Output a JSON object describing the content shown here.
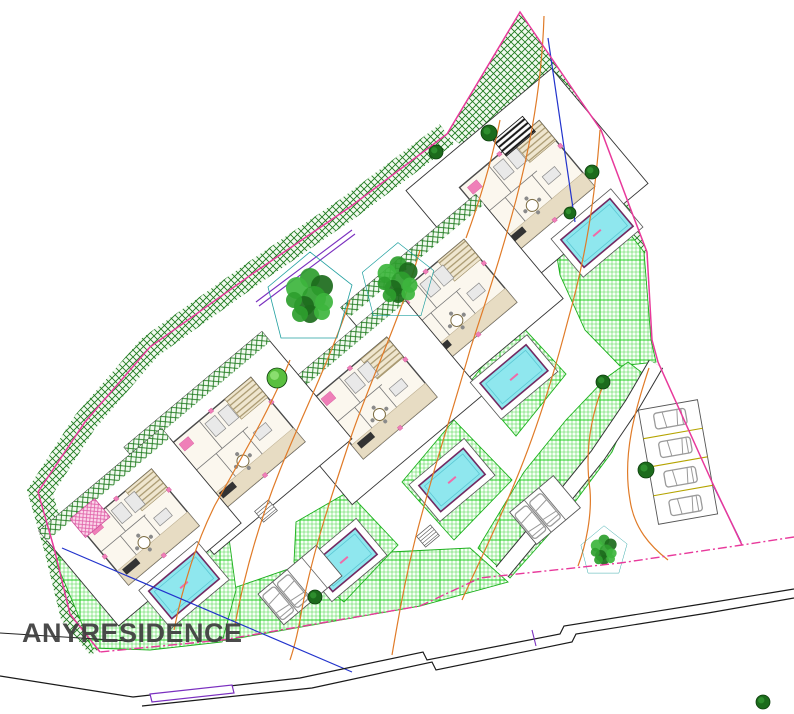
{
  "watermark": {
    "text": "ANYRESIDENCE"
  },
  "plan": {
    "kind": "villa development master site plan",
    "villa_count": 5,
    "pool_count": 5,
    "parking_area_count": 3,
    "large_tree_count": 3,
    "features": [
      "detached villas with furnished floor plans",
      "private pools",
      "landscaped gardens",
      "dense boundary planting",
      "parking stalls with cars",
      "terrain contour lines",
      "access road"
    ]
  },
  "palette": {
    "boundary": "#e8399b",
    "hatch_dark": "#1e7a1e",
    "garden_green": "#22cc22",
    "pool_fill": "#8fe7ee",
    "pool_stroke": "#732a62",
    "contour_orange": "#e07b28",
    "road_black": "#1a1a1a",
    "blue_line": "#2233cc",
    "purple_line": "#7a2fbf",
    "stall_yellow": "#b5a400",
    "car_gray": "#9a9a9a",
    "villa_wall": "#4a4a4a",
    "villa_floor": "#fbf7ee",
    "terrace_beige": "#e7dcc3",
    "deck_tan": "#c9b98f",
    "tree_dark": "#1c6b1c",
    "tree_mid": "#2e9e2e",
    "watermark_gray": "#3e3e3e",
    "pink_accent": "#ef7fb8",
    "bg": "#ffffff"
  }
}
